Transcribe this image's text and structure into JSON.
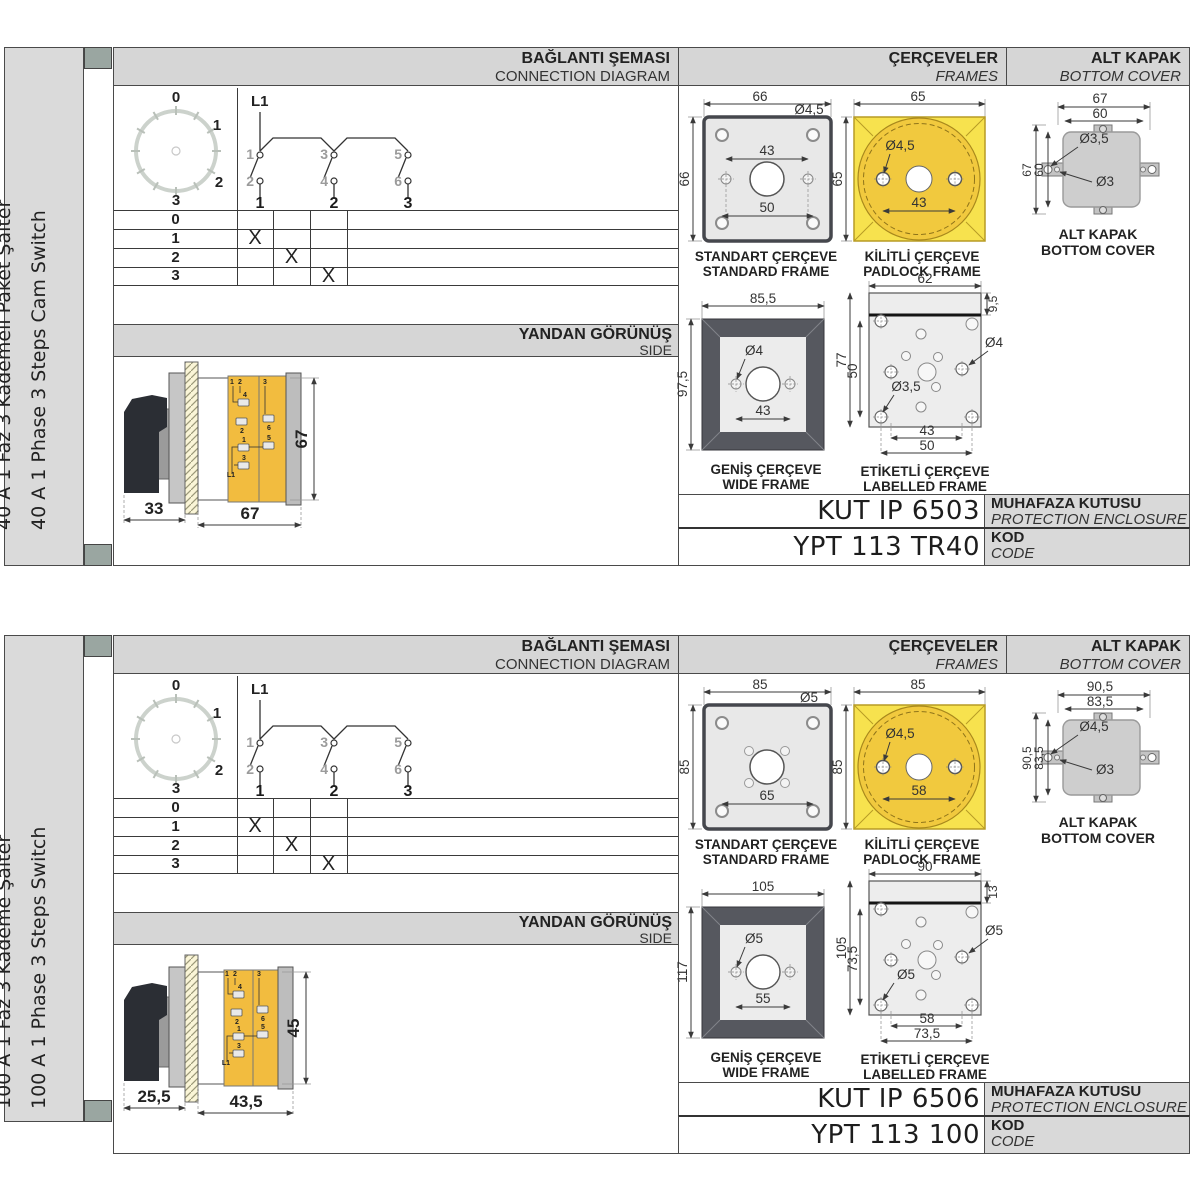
{
  "panels": [
    {
      "side_labels": {
        "tr": "40 A 1 Faz 3 Kademeli Paket Şalter",
        "en": "40 A 1 Phase 3 Steps Cam Switch"
      },
      "headers": {
        "connection_tr": "BAĞLANTI ŞEMASI",
        "connection_en": "CONNECTION DIAGRAM",
        "frames_tr": "ÇERÇEVELER",
        "frames_en": "FRAMES",
        "cover_tr": "ALT KAPAK",
        "cover_en": "BOTTOM COVER",
        "side_tr": "YANDAN GÖRÜNÜŞ",
        "side_en": "SIDE"
      },
      "dial": {
        "p0": "0",
        "p1": "1",
        "p2": "2",
        "p3": "3"
      },
      "schematic": {
        "line": "L1",
        "c1": "1",
        "c2": "2",
        "c3": "3",
        "c4": "4",
        "c5": "5",
        "c6": "6",
        "t1": "1",
        "t2": "2",
        "t3": "3"
      },
      "table": {
        "r0": "0",
        "r1": "1",
        "r2": "2",
        "r3": "3",
        "m1": "X",
        "m2": "X",
        "m3": "X"
      },
      "side_view": {
        "dim_handle": "33",
        "dim_body": "67",
        "dim_height": "67",
        "labels": {
          "a": "1",
          "b": "2",
          "c": "4",
          "d": "2",
          "e": "3",
          "f": "6",
          "g": "1",
          "h": "5",
          "i": "3",
          "j": "L1"
        }
      },
      "frames": {
        "standard": {
          "title_tr": "STANDART ÇERÇEVE",
          "title_en": "STANDARD FRAME",
          "w": "66",
          "h": "66",
          "hole": "Ø4,5",
          "d1": "43",
          "d2": "50"
        },
        "padlock": {
          "title_tr": "KİLİTLİ ÇERÇEVE",
          "title_en": "PADLOCK FRAME",
          "w": "65",
          "h": "65",
          "hole": "Ø4,5",
          "d1": "43"
        },
        "wide": {
          "title_tr": "GENİŞ ÇERÇEVE",
          "title_en": "WIDE FRAME",
          "w": "85,5",
          "h": "97,5",
          "hole": "Ø4",
          "d1": "43"
        },
        "labelled": {
          "title_tr": "ETİKETLİ ÇERÇEVE",
          "title_en": "LABELLED FRAME",
          "w": "62",
          "strip": "9,5",
          "h": "77",
          "h2": "50",
          "hole_r": "Ø4",
          "hole_b": "Ø3,5",
          "d1": "43",
          "d2": "50"
        }
      },
      "cover": {
        "caption_tr": "ALT KAPAK",
        "caption_en": "BOTTOM COVER",
        "w1": "67",
        "w2": "60",
        "h1": "67",
        "h2": "60",
        "hole1": "Ø3,5",
        "hole2": "Ø3"
      },
      "enclosure": {
        "value": "KUT IP 6503",
        "label_tr": "MUHAFAZA KUTUSU",
        "label_en": "PROTECTION ENCLOSURE"
      },
      "code": {
        "value": "YPT 113 TR40",
        "label_tr": "KOD",
        "label_en": "CODE"
      }
    },
    {
      "side_labels": {
        "tr": "100 A 1 Faz 3 Kademe Şalter",
        "en": "100 A 1 Phase 3 Steps Switch"
      },
      "headers": {
        "connection_tr": "BAĞLANTI ŞEMASI",
        "connection_en": "CONNECTION DIAGRAM",
        "frames_tr": "ÇERÇEVELER",
        "frames_en": "FRAMES",
        "cover_tr": "ALT KAPAK",
        "cover_en": "BOTTOM COVER",
        "side_tr": "YANDAN GÖRÜNÜŞ",
        "side_en": "SIDE"
      },
      "dial": {
        "p0": "0",
        "p1": "1",
        "p2": "2",
        "p3": "3"
      },
      "schematic": {
        "line": "L1",
        "c1": "1",
        "c2": "2",
        "c3": "3",
        "c4": "4",
        "c5": "5",
        "c6": "6",
        "t1": "1",
        "t2": "2",
        "t3": "3"
      },
      "table": {
        "r0": "0",
        "r1": "1",
        "r2": "2",
        "r3": "3",
        "m1": "X",
        "m2": "X",
        "m3": "X"
      },
      "side_view": {
        "dim_handle": "25,5",
        "dim_body": "43,5",
        "dim_height": "45",
        "labels": {
          "a": "1",
          "b": "2",
          "c": "4",
          "d": "2",
          "e": "3",
          "f": "6",
          "g": "1",
          "h": "5",
          "i": "3",
          "j": "L1"
        }
      },
      "frames": {
        "standard": {
          "title_tr": "STANDART ÇERÇEVE",
          "title_en": "STANDARD FRAME",
          "w": "85",
          "h": "85",
          "hole": "Ø5",
          "d1": "65"
        },
        "padlock": {
          "title_tr": "KİLİTLİ ÇERÇEVE",
          "title_en": "PADLOCK FRAME",
          "w": "85",
          "h": "85",
          "hole": "Ø4,5",
          "d1": "58"
        },
        "wide": {
          "title_tr": "GENİŞ ÇERÇEVE",
          "title_en": "WIDE FRAME",
          "w": "105",
          "h": "117",
          "hole": "Ø5",
          "d1": "55"
        },
        "labelled": {
          "title_tr": "ETİKETLİ ÇERÇEVE",
          "title_en": "LABELLED FRAME",
          "w": "90",
          "strip": "13",
          "h": "105",
          "h2": "73,5",
          "hole_r": "Ø5",
          "hole_b": "Ø5",
          "d1": "58",
          "d2": "73,5"
        }
      },
      "cover": {
        "caption_tr": "ALT KAPAK",
        "caption_en": "BOTTOM COVER",
        "w1": "90,5",
        "w2": "83,5",
        "h1": "90,5",
        "h2": "83,5",
        "hole1": "Ø4,5",
        "hole2": "Ø3"
      },
      "enclosure": {
        "value": "KUT IP 6506",
        "label_tr": "MUHAFAZA KUTUSU",
        "label_en": "PROTECTION ENCLOSURE"
      },
      "code": {
        "value": "YPT 113 100",
        "label_tr": "KOD",
        "label_en": "CODE"
      }
    }
  ]
}
